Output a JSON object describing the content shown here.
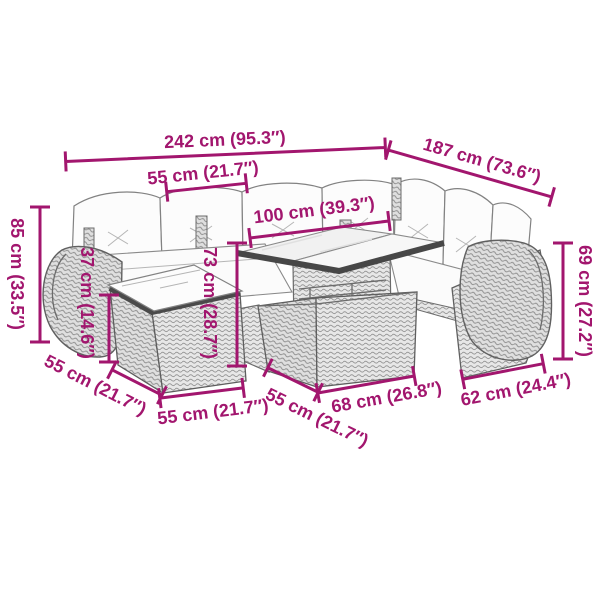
{
  "diagram": {
    "kind": "product-dimension-diagram",
    "product": "rattan-garden-lounge-set-with-cushions",
    "accent_color": "#A2166E",
    "drawing_color": "#6b6b6b",
    "background_color": "#ffffff"
  },
  "dimensions": {
    "total_width": {
      "label": "242 cm (95.3″)",
      "cm": 242,
      "inch": 95.3
    },
    "right_depth": {
      "label": "187 cm (73.6″)",
      "cm": 187,
      "inch": 73.6
    },
    "left_seat_width": {
      "label": "55 cm (21.7″)",
      "cm": 55,
      "inch": 21.7
    },
    "inner_span": {
      "label": "100 cm (39.3″)",
      "cm": 100,
      "inch": 39.3
    },
    "back_height": {
      "label": "85 cm (33.5″)",
      "cm": 85,
      "inch": 33.5
    },
    "armrest_height": {
      "label": "37 cm (14.6″)",
      "cm": 37,
      "inch": 14.6
    },
    "table_height": {
      "label": "73 cm (28.7″)",
      "cm": 73,
      "inch": 28.7
    },
    "right_back_height": {
      "label": "69 cm (27.2″)",
      "cm": 69,
      "inch": 27.2
    },
    "footstool_depth": {
      "label": "55 cm (21.7″)",
      "cm": 55,
      "inch": 21.7
    },
    "footstool_width": {
      "label": "55 cm (21.7″)",
      "cm": 55,
      "inch": 21.7
    },
    "table_depth": {
      "label": "55 cm (21.7″)",
      "cm": 55,
      "inch": 21.7
    },
    "table_width": {
      "label": "68 cm (26.8″)",
      "cm": 68,
      "inch": 26.8
    },
    "right_seat_width": {
      "label": "62 cm (24.4″)",
      "cm": 62,
      "inch": 24.4
    }
  }
}
